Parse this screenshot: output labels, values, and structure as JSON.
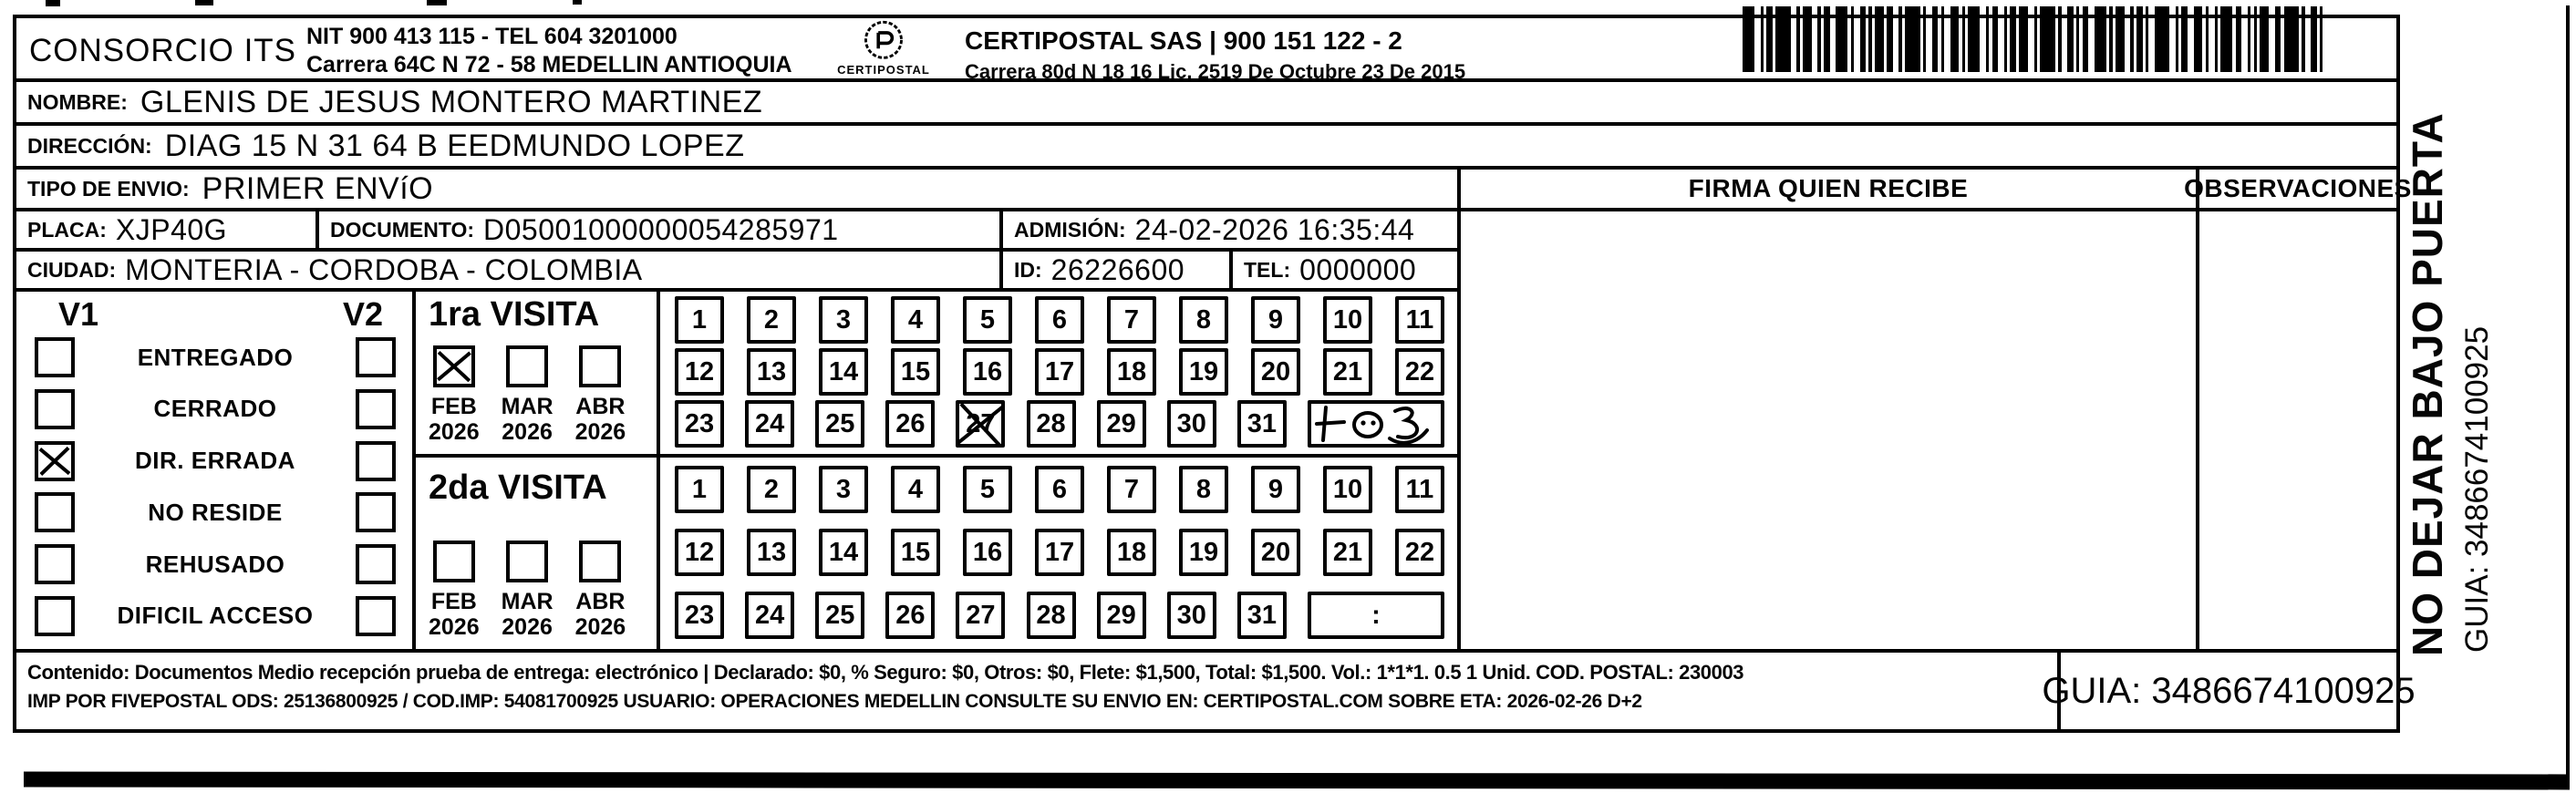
{
  "header": {
    "company_name": "CONSORCIO ITS",
    "company_nit": "NIT 900 413 115 - TEL 604 3201000",
    "company_address": "Carrera 64C N 72 - 58 MEDELLIN ANTIOQUIA",
    "logo_name": "CERTIPOSTAL",
    "operator_name": "CERTIPOSTAL SAS | 900 151 122 - 2",
    "operator_address": "Carrera 80d N 18 16  Lic. 2519 De Octubre 23 De 2015"
  },
  "fields": {
    "nombre_label": "NOMBRE:",
    "nombre": "GLENIS DE JESUS MONTERO MARTINEZ",
    "direccion_label": "DIRECCIÓN:",
    "direccion": "DIAG 15 N 31 64 B EEDMUNDO LOPEZ",
    "tipo_envio_label": "TIPO DE ENVIO:",
    "tipo_envio": "PRIMER ENVíO",
    "placa_label": "PLACA:",
    "placa": "XJP40G",
    "documento_label": "DOCUMENTO:",
    "documento": "D05001000000054285971",
    "admision_label": "ADMISIÓN:",
    "admision": "24-02-2026 16:35:44",
    "ciudad_label": "CIUDAD:",
    "ciudad": "MONTERIA - CORDOBA - COLOMBIA",
    "id_label": "ID:",
    "id": "26226600",
    "tel_label": "TEL:",
    "tel": "0000000"
  },
  "columns": {
    "firma": "FIRMA QUIEN RECIBE",
    "observaciones": "OBSERVACIONES"
  },
  "status": {
    "v1_header": "V1",
    "v2_header": "V2",
    "options": [
      {
        "label": "ENTREGADO",
        "v1": false,
        "v2": false
      },
      {
        "label": "CERRADO",
        "v1": false,
        "v2": false
      },
      {
        "label": "DIR. ERRADA",
        "v1": true,
        "v2": false
      },
      {
        "label": "NO RESIDE",
        "v1": false,
        "v2": false
      },
      {
        "label": "REHUSADO",
        "v1": false,
        "v2": false
      },
      {
        "label": "DIFICIL ACCESO",
        "v1": false,
        "v2": false
      }
    ]
  },
  "calendar": {
    "days": [
      "1",
      "2",
      "3",
      "4",
      "5",
      "6",
      "7",
      "8",
      "9",
      "10",
      "11",
      "12",
      "13",
      "14",
      "15",
      "16",
      "17",
      "18",
      "19",
      "20",
      "21",
      "22",
      "23",
      "24",
      "25",
      "26",
      "27",
      "28",
      "29",
      "30",
      "31"
    ]
  },
  "visits": [
    {
      "title": "1ra VISITA",
      "months": [
        {
          "month": "FEB",
          "year": "2026",
          "checked": true
        },
        {
          "month": "MAR",
          "year": "2026",
          "checked": false
        },
        {
          "month": "ABR",
          "year": "2026",
          "checked": false
        }
      ],
      "day27_crossed": true
    },
    {
      "title": "2da VISITA",
      "months": [
        {
          "month": "FEB",
          "year": "2026",
          "checked": false
        },
        {
          "month": "MAR",
          "year": "2026",
          "checked": false
        },
        {
          "month": "ABR",
          "year": "2026",
          "checked": false
        }
      ],
      "day27_crossed": false,
      "time_box": ":"
    }
  ],
  "sidebar": {
    "warning": "NO DEJAR BAJO PUERTA",
    "guia": "GUIA: 3486674100925"
  },
  "footer": {
    "line1": "Contenido: Documentos Medio recepción prueba de entrega: electrónico | Declarado: $0, % Seguro: $0, Otros: $0, Flete: $1,500, Total: $1,500. Vol.: 1*1*1. 0.5 1 Unid. COD. POSTAL: 230003",
    "line2": "IMP POR FIVEPOSTAL ODS: 25136800925 / COD.IMP: 54081700925 USUARIO: OPERACIONES MEDELLIN CONSULTE SU ENVIO EN: CERTIPOSTAL.COM SOBRE ETA: 2026-02-26 D+2",
    "guia": "GUIA: 3486674100925"
  }
}
